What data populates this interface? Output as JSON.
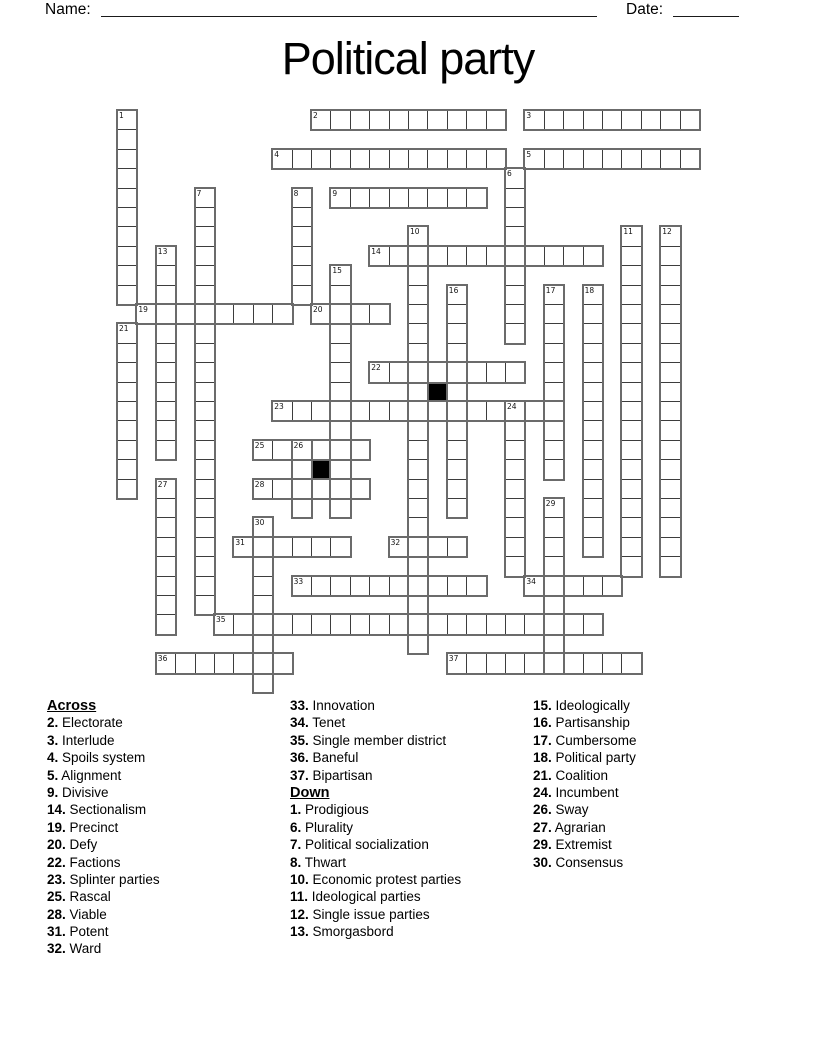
{
  "header": {
    "name_label": "Name:",
    "date_label": "Date:"
  },
  "title": "Political party",
  "grid": {
    "rows": 30,
    "cols": 30,
    "colors": {
      "grid_line": "#3d3d3d",
      "word_outline": "#6b6b6b",
      "black_cell": "#000000"
    },
    "words": [
      {
        "num": 2,
        "dir": "across",
        "row": 0,
        "col": 10,
        "len": 10
      },
      {
        "num": 3,
        "dir": "across",
        "row": 0,
        "col": 21,
        "len": 9
      },
      {
        "num": 4,
        "dir": "across",
        "row": 2,
        "col": 8,
        "len": 12
      },
      {
        "num": 5,
        "dir": "across",
        "row": 2,
        "col": 21,
        "len": 9
      },
      {
        "num": 9,
        "dir": "across",
        "row": 4,
        "col": 11,
        "len": 8
      },
      {
        "num": 14,
        "dir": "across",
        "row": 7,
        "col": 13,
        "len": 12
      },
      {
        "num": 19,
        "dir": "across",
        "row": 10,
        "col": 1,
        "len": 8
      },
      {
        "num": 20,
        "dir": "across",
        "row": 10,
        "col": 10,
        "len": 4
      },
      {
        "num": 22,
        "dir": "across",
        "row": 13,
        "col": 13,
        "len": 8
      },
      {
        "num": 23,
        "dir": "across",
        "row": 15,
        "col": 8,
        "len": 15
      },
      {
        "num": 25,
        "dir": "across",
        "row": 17,
        "col": 7,
        "len": 6
      },
      {
        "num": 28,
        "dir": "across",
        "row": 19,
        "col": 7,
        "len": 6
      },
      {
        "num": 31,
        "dir": "across",
        "row": 22,
        "col": 6,
        "len": 6
      },
      {
        "num": 32,
        "dir": "across",
        "row": 22,
        "col": 14,
        "len": 4
      },
      {
        "num": 33,
        "dir": "across",
        "row": 24,
        "col": 9,
        "len": 10
      },
      {
        "num": 34,
        "dir": "across",
        "row": 24,
        "col": 21,
        "len": 5
      },
      {
        "num": 35,
        "dir": "across",
        "row": 26,
        "col": 5,
        "len": 20
      },
      {
        "num": 36,
        "dir": "across",
        "row": 28,
        "col": 2,
        "len": 7
      },
      {
        "num": 37,
        "dir": "across",
        "row": 28,
        "col": 17,
        "len": 10
      },
      {
        "num": 1,
        "dir": "down",
        "row": 0,
        "col": 0,
        "len": 10
      },
      {
        "num": 6,
        "dir": "down",
        "row": 3,
        "col": 20,
        "len": 9
      },
      {
        "num": 7,
        "dir": "down",
        "row": 4,
        "col": 4,
        "len": 22
      },
      {
        "num": 8,
        "dir": "down",
        "row": 4,
        "col": 9,
        "len": 6
      },
      {
        "num": 10,
        "dir": "down",
        "row": 6,
        "col": 15,
        "len": 22
      },
      {
        "num": 11,
        "dir": "down",
        "row": 6,
        "col": 26,
        "len": 18
      },
      {
        "num": 12,
        "dir": "down",
        "row": 6,
        "col": 28,
        "len": 18
      },
      {
        "num": 13,
        "dir": "down",
        "row": 7,
        "col": 2,
        "len": 11
      },
      {
        "num": 15,
        "dir": "down",
        "row": 8,
        "col": 11,
        "len": 13
      },
      {
        "num": 16,
        "dir": "down",
        "row": 9,
        "col": 17,
        "len": 12
      },
      {
        "num": 17,
        "dir": "down",
        "row": 9,
        "col": 22,
        "len": 10
      },
      {
        "num": 18,
        "dir": "down",
        "row": 9,
        "col": 24,
        "len": 14
      },
      {
        "num": 21,
        "dir": "down",
        "row": 11,
        "col": 0,
        "len": 9
      },
      {
        "num": 24,
        "dir": "down",
        "row": 15,
        "col": 20,
        "len": 9
      },
      {
        "num": 26,
        "dir": "down",
        "row": 17,
        "col": 9,
        "len": 4
      },
      {
        "num": 27,
        "dir": "down",
        "row": 19,
        "col": 2,
        "len": 8
      },
      {
        "num": 29,
        "dir": "down",
        "row": 20,
        "col": 22,
        "len": 9
      },
      {
        "num": 30,
        "dir": "down",
        "row": 21,
        "col": 7,
        "len": 9
      }
    ],
    "black_cells": [
      {
        "col": 16,
        "row": 14
      },
      {
        "col": 10,
        "row": 18
      }
    ]
  },
  "clue_columns": [
    {
      "items": [
        {
          "heading": "Across"
        },
        {
          "num": "2",
          "text": "Electorate"
        },
        {
          "num": "3",
          "text": "Interlude"
        },
        {
          "num": "4",
          "text": "Spoils system"
        },
        {
          "num": "5",
          "text": "Alignment"
        },
        {
          "num": "9",
          "text": "Divisive"
        },
        {
          "num": "14",
          "text": "Sectionalism"
        },
        {
          "num": "19",
          "text": "Precinct"
        },
        {
          "num": "20",
          "text": "Defy"
        },
        {
          "num": "22",
          "text": "Factions"
        },
        {
          "num": "23",
          "text": "Splinter parties"
        },
        {
          "num": "25",
          "text": "Rascal"
        },
        {
          "num": "28",
          "text": "Viable"
        },
        {
          "num": "31",
          "text": "Potent"
        },
        {
          "num": "32",
          "text": "Ward"
        }
      ]
    },
    {
      "items": [
        {
          "num": "33",
          "text": "Innovation"
        },
        {
          "num": "34",
          "text": "Tenet"
        },
        {
          "num": "35",
          "text": "Single member district"
        },
        {
          "num": "36",
          "text": "Baneful"
        },
        {
          "num": "37",
          "text": "Bipartisan"
        },
        {
          "heading": "Down"
        },
        {
          "num": "1",
          "text": "Prodigious"
        },
        {
          "num": "6",
          "text": "Plurality"
        },
        {
          "num": "7",
          "text": "Political socialization"
        },
        {
          "num": "8",
          "text": "Thwart"
        },
        {
          "num": "10",
          "text": "Economic protest parties"
        },
        {
          "num": "11",
          "text": "Ideological parties"
        },
        {
          "num": "12",
          "text": "Single issue parties"
        },
        {
          "num": "13",
          "text": "Smorgasbord"
        }
      ]
    },
    {
      "items": [
        {
          "num": "15",
          "text": "Ideologically"
        },
        {
          "num": "16",
          "text": "Partisanship"
        },
        {
          "num": "17",
          "text": "Cumbersome"
        },
        {
          "num": "18",
          "text": "Political party"
        },
        {
          "num": "21",
          "text": "Coalition"
        },
        {
          "num": "24",
          "text": "Incumbent"
        },
        {
          "num": "26",
          "text": "Sway"
        },
        {
          "num": "27",
          "text": "Agrarian"
        },
        {
          "num": "29",
          "text": "Extremist"
        },
        {
          "num": "30",
          "text": "Consensus"
        }
      ]
    }
  ]
}
